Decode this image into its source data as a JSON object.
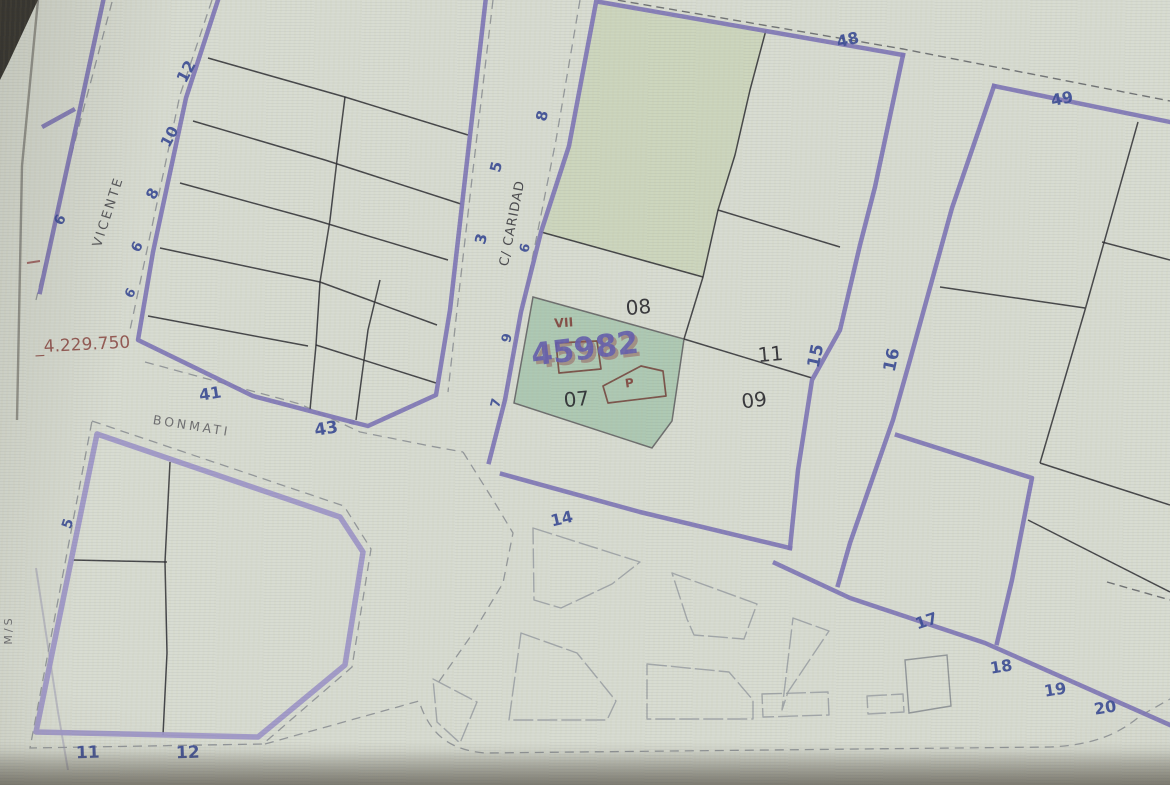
{
  "map": {
    "coordinate_label": "_4.229.750",
    "streets": {
      "vicente": "VICENTE",
      "caridad": "C/ CARIDAD",
      "bonmati": "BONMATI",
      "edge": "M/S"
    },
    "parcel": {
      "number": "45982",
      "block": "VII",
      "building": "P",
      "p07": "07",
      "p08": "08",
      "p09": "09",
      "p11": "11"
    },
    "houses": {
      "n12t": "12",
      "n10": "10",
      "n8v": "8",
      "n6v": "6",
      "n6w": "6",
      "n6l": "6",
      "n41": "41",
      "n43": "43",
      "n3": "3",
      "n5c": "5",
      "n8c": "8",
      "n6c": "6",
      "n9c": "9",
      "n7c": "7",
      "n48": "48",
      "n49": "49",
      "n15": "15",
      "n16": "16",
      "n14": "14",
      "n17": "17",
      "n18": "18",
      "n19": "19",
      "n20": "20",
      "n11b": "11",
      "n12b": "12",
      "n5b": "5"
    },
    "colors": {
      "background": "#d8dcd2",
      "street_purple": "#8075c7",
      "street_light_purple": "#a198d6",
      "parcel_line": "#27272e",
      "sidewalk_gray": "#878d94",
      "house_number_blue": "#3349a8",
      "parcel_number_black": "#22222a",
      "annotation_red": "#9a4640",
      "building_outline_brown": "#7e4238",
      "selected_number_purple": "#635bc0",
      "selected_parcel_fill": "#8fc3a0",
      "upper_parcel_tint": "#bcd196"
    }
  }
}
